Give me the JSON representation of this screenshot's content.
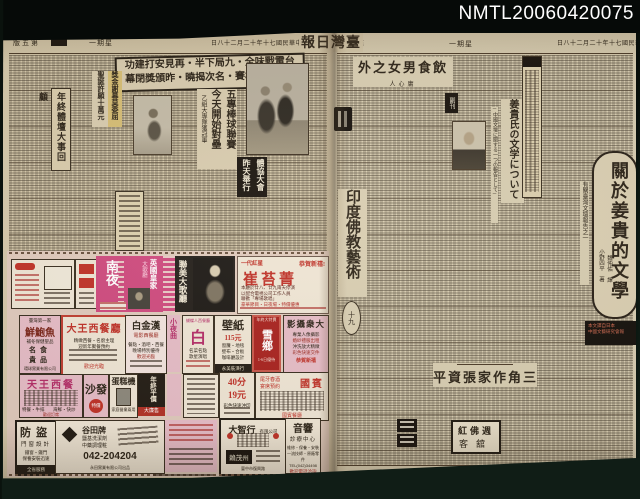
{
  "archive_id": "NMTL20060420075",
  "colors": {
    "backdrop": "#12221a",
    "paper": "#d5c8aa",
    "ink": "#2e2519",
    "magenta": "#cf4a7e",
    "red": "#bf3127"
  },
  "masthead": {
    "title": "報日灣臺",
    "date": "日八十二月二十年十七國民華中",
    "weekday": "一期星",
    "page_left": "版五第",
    "page_right": "版八第"
  },
  "left_page": {
    "sports_box": {
      "line1": "功建打安見再・半下局九・全味戰電台",
      "line2": "幕閉獎頒昨・曉揭次名・賽棒成盃華中"
    },
    "league": {
      "col1": "五專棒球聯賽",
      "col2": "今天開始對壘",
      "sub": "乙組大專隊獲冠軍"
    },
    "side_box_headline": "年終體壇大事回顧",
    "bonus": {
      "col1": "獎金謝幕莫委屈",
      "col2": "聖誕許願十萬元"
    },
    "assoc": {
      "col1": "體協大會",
      "col2": "昨天舉行"
    },
    "ads": {
      "nightclub": {
        "name": "南夜",
        "royal": "英國皇家",
        "royal_sub": "大歌廳"
      },
      "lianmei": {
        "name": "聯美大歌廳"
      },
      "cui": {
        "tag": "一代紅星",
        "greet": "恭賀新禧!",
        "name": "崔苔菁",
        "l1": "本廳於廿八、廿九兩天停演",
        "l2": "以配合電視公司工作人員",
        "l3": "聯歡「專場歌唱」",
        "l4": "豪華節目・日夜場・特價優惠"
      },
      "abalone": {
        "top": "臺灣第一家",
        "name": "鮮鮑魚",
        "sub": "補冬保健聖品",
        "a": "名食",
        "b": "貴品",
        "foot": "環球實業有限公司"
      },
      "dawang": {
        "name": "大王西餐廳",
        "l1": "精緻西餐・名廚主理",
        "l2": "迎新年聚餐預約",
        "foot": "歡迎光臨"
      },
      "baijinhan": {
        "name": "白金漢",
        "sub": "電影西餐廳",
        "l1": "餐點・酒吧・西餐",
        "l2": "晚場特別優待",
        "l3": "歡迎光臨"
      },
      "xiaoyequ": {
        "name": "小夜曲"
      },
      "bai": {
        "head": "蝴蝶人西餐廳",
        "name": "白",
        "l1": "名菜名點",
        "l2": "歌星演唱"
      },
      "wallpaper": {
        "name": "壁紙",
        "price": "115元",
        "l1": "窗簾・地毯",
        "l2": "壁布・合板",
        "l3": "咖啡廳設計",
        "foot": "永美裝潢行"
      },
      "xue": {
        "chip": "年終大特賣",
        "name": "雪鄉",
        "line": "1-6日優待"
      },
      "photo_studio": {
        "name": "影攝衆大",
        "l1": "專業人像攝影",
        "l2": "婚紗禮服出租",
        "l3": "沖洗放大精緻",
        "l4": "彩色快速交件",
        "foot": "恭賀新禧"
      },
      "tianwang": {
        "name": "天王西餐",
        "l1": "特餐・牛排",
        "l2": "海鮮・快炒",
        "foot": "歡迎訂席"
      },
      "sofa": {
        "name": "沙發",
        "chip": "特價"
      },
      "cakemachine": {
        "name": "蛋糕機",
        "line": "家庭營業兩用"
      },
      "discount": {
        "name": "年終平價",
        "band": "大廉售"
      },
      "printshop": {
        "n1": "40分",
        "n2": "19元",
        "line": "彩色快速沖印"
      },
      "guobin": {
        "name": "國賓",
        "l1": "尾牙春酒",
        "l2": "宴席預約",
        "foot": "國賓餐廳"
      },
      "security": {
        "name": "防盜",
        "sub": "門窗設計",
        "l1": "鐵窗・鐵門",
        "l2": "保養安裝迅速",
        "foot": "全省服務"
      },
      "gutian": {
        "name": "谷田牌",
        "l1": "鹽基洗潔劑",
        "l2": "中藥調理粧",
        "phone": "042-204204",
        "foot": "永田實業有限公司出品"
      },
      "dazhixing": {
        "name": "大智行",
        "sub": "有限公司",
        "box": "賴茂州",
        "foot": "臺中市復興路"
      },
      "audio": {
        "name": "音響",
        "sub": "診療中心",
        "l1": "維修・保養・安裝",
        "l2": "一流技師・原廠零件",
        "l3": "TEL(042)34498",
        "red": "歡迎電話洽詢"
      }
    }
  },
  "right_page": {
    "essay": {
      "title": "外之女男食飲",
      "author": "人心庸"
    },
    "jp": {
      "chip": "副刊",
      "title": "姜貴氏の文学について",
      "sub": "─中國文壇に關する一つの報告として─"
    },
    "feature": {
      "title": "關於姜貴的文學",
      "note": "有關臺灣文壇報告之一",
      "author1": "小野四平　著",
      "author2": "魏仲佑　譯",
      "footnote1": "本文譯自日本",
      "footnote2": "中國文藝研究會報"
    },
    "buddhist": {
      "title": "印度佛教藝術",
      "part": "十九"
    },
    "zhang": {
      "title": "平資張家作角三"
    },
    "hotel": {
      "line1": "紅佛週",
      "line2": "客舘"
    }
  }
}
